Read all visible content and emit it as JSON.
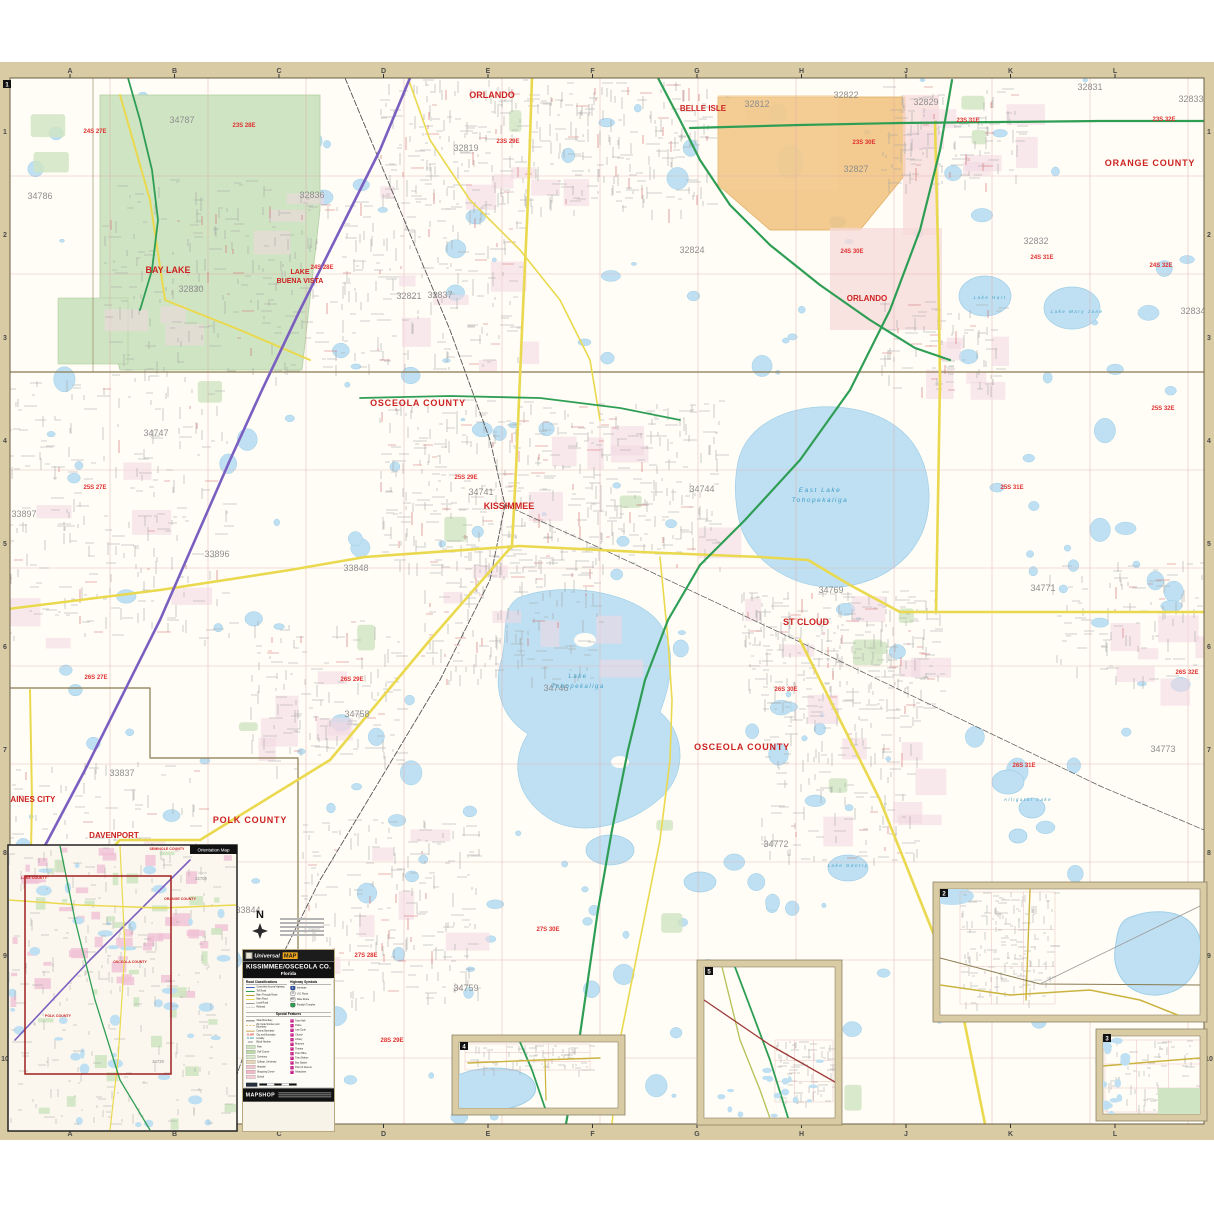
{
  "brand": {
    "name1": "Universal",
    "name2": "MAP"
  },
  "title": {
    "line1": "KISSIMMEE/OSCEOLA CO.",
    "line2": "Florida"
  },
  "footer": {
    "brand": "MAPSHOP"
  },
  "north": {
    "label": "N"
  },
  "grid": {
    "top_letters": [
      "A",
      "B",
      "C",
      "D",
      "E",
      "F",
      "G",
      "H",
      "J",
      "K",
      "L"
    ],
    "side_numbers": [
      "1",
      "2",
      "3",
      "4",
      "5",
      "6",
      "7",
      "8",
      "9",
      "10"
    ]
  },
  "corner_badges": [
    {
      "text": "1",
      "x": 3,
      "y": 80
    },
    {
      "text": "2",
      "x": 940,
      "y": 889
    },
    {
      "text": "3",
      "x": 1103,
      "y": 1034
    },
    {
      "text": "4",
      "x": 460,
      "y": 1042
    },
    {
      "text": "5",
      "x": 705,
      "y": 967
    }
  ],
  "legend": {
    "road_class_header": "Road Classifications",
    "hwy_header": "Highway Symbols",
    "special_header": "Special Features",
    "road_classes": [
      {
        "label": "Controlled Access Highway",
        "color": "#3b5fc0"
      },
      {
        "label": "Toll Road",
        "color": "#2f9e55"
      },
      {
        "label": "Main Through Route",
        "color": "#b7a437"
      },
      {
        "label": "Main Road",
        "color": "#ead94e"
      },
      {
        "label": "Local Road",
        "color": "#9a9a9a"
      },
      {
        "label": "Railroad",
        "color": "#444444"
      }
    ],
    "hwy_symbols": [
      {
        "label": "Interstate",
        "color": "#2b4fad",
        "glyph": "4"
      },
      {
        "label": "U.S. Route",
        "color": "#f5f5f5",
        "glyph": "17",
        "dark": true
      },
      {
        "label": "State Route",
        "color": "#f5f5f5",
        "glyph": "535",
        "dark": true
      },
      {
        "label": "Florida's Turnpike",
        "color": "#2f9e55",
        "glyph": ""
      }
    ],
    "special_left": [
      {
        "label": "State Boundary",
        "type": "line",
        "color": "#777777"
      },
      {
        "label": "Zip Code Number and Boundary",
        "type": "dash",
        "color": "#e09a3c"
      },
      {
        "label": "County Boundary",
        "type": "line",
        "color": "#caa85a"
      },
      {
        "label": "City and Boundary",
        "type": "text",
        "color": "#cc2a2a",
        "sample": "CLAIR"
      },
      {
        "label": "Locality",
        "type": "text",
        "color": "#3f9fc6",
        "sample": "CLAIR"
      },
      {
        "label": "Block Number",
        "type": "text",
        "color": "#888888",
        "sample": "1200"
      },
      {
        "label": "Park",
        "type": "box",
        "color": "#cfe4c2"
      },
      {
        "label": "Golf Course",
        "type": "box",
        "color": "#bcd9a8"
      },
      {
        "label": "Cemetery",
        "type": "box",
        "color": "#d8e8cc"
      },
      {
        "label": "College, University",
        "type": "box",
        "color": "#e8d9b8"
      },
      {
        "label": "Hospital",
        "type": "box",
        "color": "#f0c8d4"
      },
      {
        "label": "Shopping Center",
        "type": "box",
        "color": "#f4b8c8"
      },
      {
        "label": "School",
        "type": "box",
        "color": "#f4cfd8"
      }
    ],
    "special_right": [
      {
        "label": "Town Hall"
      },
      {
        "label": "Police"
      },
      {
        "label": "Law Court"
      },
      {
        "label": "Church"
      },
      {
        "label": "Library"
      },
      {
        "label": "Museum"
      },
      {
        "label": "Theatre"
      },
      {
        "label": "Post Office"
      },
      {
        "label": "Train Station"
      },
      {
        "label": "Bus Station"
      },
      {
        "label": "Point of Interest"
      },
      {
        "label": "Attractions"
      }
    ],
    "icon_color": "#c4208a"
  },
  "labels": {
    "counties": [
      {
        "text": "ORANGE COUNTY",
        "x": 1150,
        "y": 166,
        "size": 9
      },
      {
        "text": "OSCEOLA COUNTY",
        "x": 418,
        "y": 406,
        "size": 9
      },
      {
        "text": "OSCEOLA COUNTY",
        "x": 742,
        "y": 750,
        "size": 9
      },
      {
        "text": "POLK COUNTY",
        "x": 250,
        "y": 823,
        "size": 9
      },
      {
        "text": "OSCEOLA COUNTY",
        "x": 1158,
        "y": 937,
        "size": 7
      },
      {
        "text": "POLK COUNTY",
        "x": 1053,
        "y": 993,
        "size": 7
      },
      {
        "text": "OSCEOLA COUNTY",
        "x": 1157,
        "y": 1046,
        "size": 6
      },
      {
        "text": "OSCEOLA COUNTY",
        "x": 779,
        "y": 986,
        "size": 7
      },
      {
        "text": "OSCEOLA COUNTY",
        "x": 507,
        "y": 1101,
        "size": 7
      }
    ],
    "cities": [
      {
        "text": "ORLANDO",
        "x": 492,
        "y": 98,
        "size": 9
      },
      {
        "text": "BELLE ISLE",
        "x": 703,
        "y": 111,
        "size": 8
      },
      {
        "text": "ORLANDO",
        "x": 867,
        "y": 301,
        "size": 8
      },
      {
        "text": "BAY LAKE",
        "x": 168,
        "y": 273,
        "size": 9
      },
      {
        "text": "LAKE",
        "x": 300,
        "y": 274,
        "size": 7
      },
      {
        "text": "BUENA VISTA",
        "x": 300,
        "y": 283,
        "size": 7
      },
      {
        "text": "KISSIMMEE",
        "x": 509,
        "y": 509,
        "size": 9
      },
      {
        "text": "ST CLOUD",
        "x": 806,
        "y": 625,
        "size": 9
      },
      {
        "text": "DAVENPORT",
        "x": 114,
        "y": 838,
        "size": 8
      },
      {
        "text": "HAINES CITY",
        "x": 30,
        "y": 802,
        "size": 8
      }
    ],
    "zips": [
      {
        "text": "34786",
        "x": 40,
        "y": 199
      },
      {
        "text": "34787",
        "x": 182,
        "y": 123
      },
      {
        "text": "32819",
        "x": 466,
        "y": 151
      },
      {
        "text": "32836",
        "x": 312,
        "y": 198
      },
      {
        "text": "32821",
        "x": 409,
        "y": 299
      },
      {
        "text": "32830",
        "x": 191,
        "y": 292
      },
      {
        "text": "32837",
        "x": 440,
        "y": 298
      },
      {
        "text": "32824",
        "x": 692,
        "y": 253
      },
      {
        "text": "32812",
        "x": 757,
        "y": 107
      },
      {
        "text": "32822",
        "x": 846,
        "y": 98
      },
      {
        "text": "32829",
        "x": 926,
        "y": 105
      },
      {
        "text": "32827",
        "x": 856,
        "y": 172
      },
      {
        "text": "32831",
        "x": 1090,
        "y": 90
      },
      {
        "text": "32832",
        "x": 1036,
        "y": 244
      },
      {
        "text": "32833",
        "x": 1191,
        "y": 102
      },
      {
        "text": "32834",
        "x": 1193,
        "y": 314
      },
      {
        "text": "34747",
        "x": 156,
        "y": 436
      },
      {
        "text": "33897",
        "x": 24,
        "y": 517
      },
      {
        "text": "33896",
        "x": 217,
        "y": 557
      },
      {
        "text": "33848",
        "x": 356,
        "y": 571
      },
      {
        "text": "34741",
        "x": 481,
        "y": 495
      },
      {
        "text": "34744",
        "x": 702,
        "y": 492
      },
      {
        "text": "34746",
        "x": 556,
        "y": 691
      },
      {
        "text": "34758",
        "x": 357,
        "y": 717
      },
      {
        "text": "34769",
        "x": 831,
        "y": 593
      },
      {
        "text": "34771",
        "x": 1043,
        "y": 591
      },
      {
        "text": "34772",
        "x": 776,
        "y": 847
      },
      {
        "text": "34773",
        "x": 1163,
        "y": 752
      },
      {
        "text": "33844",
        "x": 248,
        "y": 913
      },
      {
        "text": "33837",
        "x": 122,
        "y": 776
      },
      {
        "text": "34759",
        "x": 466,
        "y": 991
      },
      {
        "text": "34759",
        "x": 1068,
        "y": 941
      },
      {
        "text": "33844",
        "x": 953,
        "y": 920
      },
      {
        "text": "33844",
        "x": 1098,
        "y": 973
      },
      {
        "text": "34773",
        "x": 1164,
        "y": 1088
      },
      {
        "text": "34739",
        "x": 524,
        "y": 1078
      },
      {
        "text": "34972",
        "x": 730,
        "y": 1020
      }
    ],
    "townships": [
      {
        "text": "23S 28E",
        "x": 244,
        "y": 127
      },
      {
        "text": "23S 29E",
        "x": 508,
        "y": 143
      },
      {
        "text": "23S 30E",
        "x": 864,
        "y": 144
      },
      {
        "text": "23S 31E",
        "x": 968,
        "y": 122
      },
      {
        "text": "23S 32E",
        "x": 1164,
        "y": 121
      },
      {
        "text": "24S 27E",
        "x": 95,
        "y": 133
      },
      {
        "text": "24S 28E",
        "x": 322,
        "y": 269
      },
      {
        "text": "24S 30E",
        "x": 852,
        "y": 253
      },
      {
        "text": "24S 31E",
        "x": 1042,
        "y": 259
      },
      {
        "text": "24S 32E",
        "x": 1161,
        "y": 267
      },
      {
        "text": "25S 27E",
        "x": 95,
        "y": 489
      },
      {
        "text": "25S 29E",
        "x": 466,
        "y": 479
      },
      {
        "text": "25S 31E",
        "x": 1012,
        "y": 489
      },
      {
        "text": "25S 32E",
        "x": 1163,
        "y": 410
      },
      {
        "text": "26S 27E",
        "x": 96,
        "y": 679
      },
      {
        "text": "26S 29E",
        "x": 352,
        "y": 681
      },
      {
        "text": "26S 30E",
        "x": 786,
        "y": 691
      },
      {
        "text": "26S 31E",
        "x": 1024,
        "y": 767
      },
      {
        "text": "26S 32E",
        "x": 1187,
        "y": 674
      },
      {
        "text": "27S 28E",
        "x": 366,
        "y": 957
      },
      {
        "text": "27S 30E",
        "x": 548,
        "y": 931
      },
      {
        "text": "28S 29E",
        "x": 392,
        "y": 1042
      },
      {
        "text": "28S 28E",
        "x": 1000,
        "y": 941
      },
      {
        "text": "28S 29E",
        "x": 1150,
        "y": 995
      },
      {
        "text": "27S 32E",
        "x": 1110,
        "y": 1053
      },
      {
        "text": "27S 33E",
        "x": 1172,
        "y": 1053
      },
      {
        "text": "30S 30E",
        "x": 581,
        "y": 1073
      },
      {
        "text": "31S 34E",
        "x": 766,
        "y": 975
      },
      {
        "text": "32S 34E",
        "x": 764,
        "y": 1048
      }
    ],
    "lakes": [
      {
        "text": "East Lake",
        "x": 820,
        "y": 492,
        "size": 6.5
      },
      {
        "text": "Tohopekaliga",
        "x": 820,
        "y": 502,
        "size": 6.5
      },
      {
        "text": "Lake",
        "x": 578,
        "y": 678,
        "size": 6
      },
      {
        "text": "Tohopekaliga",
        "x": 578,
        "y": 688,
        "size": 6
      },
      {
        "text": "Lake Hart",
        "x": 990,
        "y": 299,
        "size": 4.5
      },
      {
        "text": "Lake Mary Jane",
        "x": 1077,
        "y": 313,
        "size": 4.5
      },
      {
        "text": "Lake Gentry",
        "x": 848,
        "y": 867,
        "size": 4.5
      },
      {
        "text": "Alligator Lake",
        "x": 1028,
        "y": 801,
        "size": 4.5
      },
      {
        "text": "Lake Hatchineha",
        "x": 1164,
        "y": 948,
        "size": 5
      },
      {
        "text": "Lake Marian",
        "x": 492,
        "y": 1089,
        "size": 4.5
      }
    ]
  },
  "orientation_inset": {
    "tab": "Orientation Map",
    "red_labels": [
      {
        "text": "SEMINOLE COUNTY",
        "x": 167,
        "y": 850
      },
      {
        "text": "LAKE COUNTY",
        "x": 34,
        "y": 879
      },
      {
        "text": "ORANGE COUNTY",
        "x": 180,
        "y": 900
      },
      {
        "text": "OSCEOLA COUNTY",
        "x": 130,
        "y": 963
      },
      {
        "text": "POLK COUNTY",
        "x": 58,
        "y": 1017
      }
    ],
    "gray_labels": [
      {
        "text": "32709",
        "x": 201,
        "y": 880
      },
      {
        "text": "34739",
        "x": 158,
        "y": 1063
      }
    ]
  }
}
